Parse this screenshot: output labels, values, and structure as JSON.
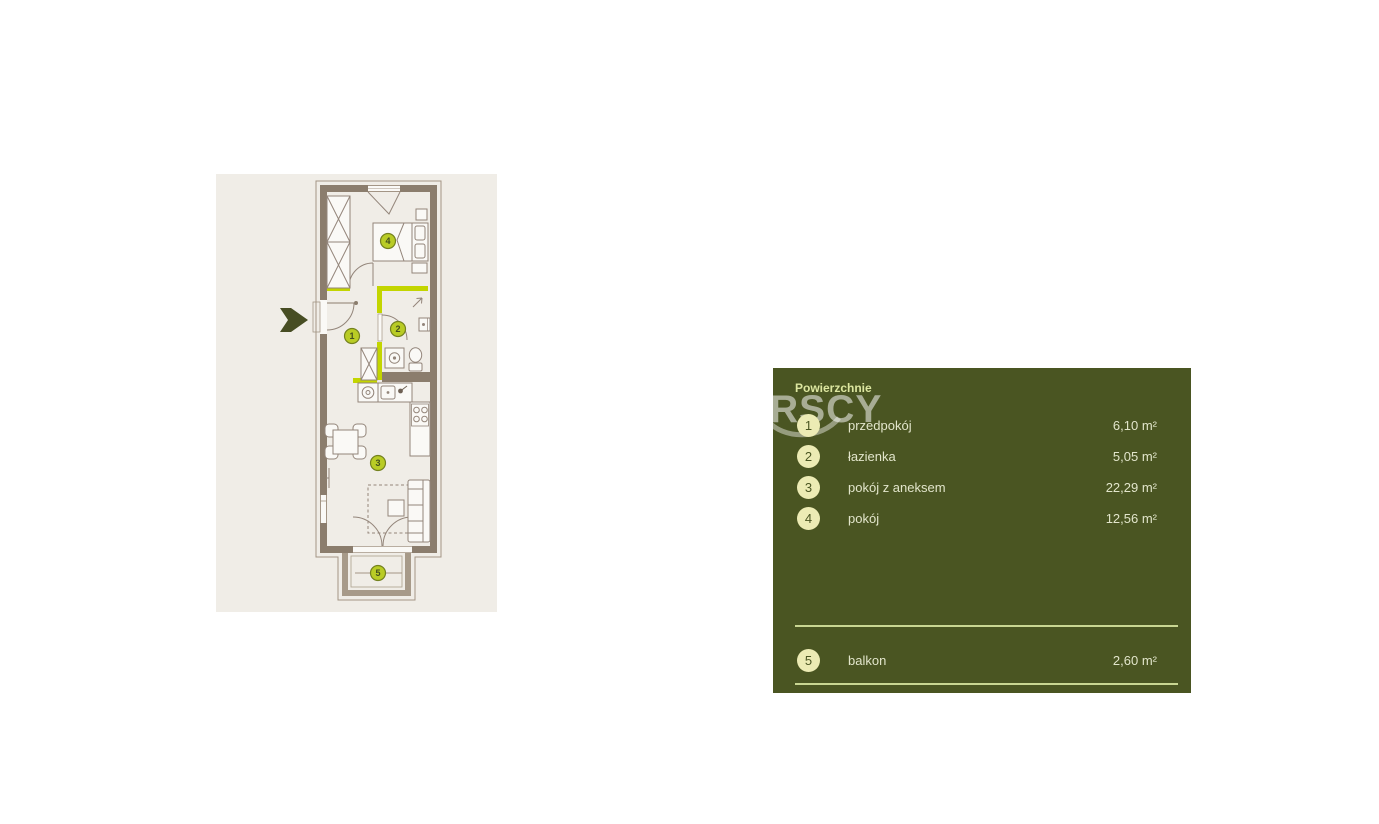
{
  "legend": {
    "title": "Powierzchnie",
    "watermark": "RSCY",
    "rows": [
      {
        "num": "1",
        "label": "przedpokój",
        "area": "6,10 m²"
      },
      {
        "num": "2",
        "label": "łazienka",
        "area": "5,05 m²"
      },
      {
        "num": "3",
        "label": "pokój z aneksem",
        "area": "22,29 m²"
      },
      {
        "num": "4",
        "label": "pokój",
        "area": "12,56 m²"
      }
    ],
    "footer_row": {
      "num": "5",
      "label": "balkon",
      "area": "2,60 m²"
    }
  },
  "plan": {
    "badges": [
      "1",
      "2",
      "3",
      "4",
      "5"
    ],
    "icons": {
      "entry_arrow": "right-chevron-arrow"
    },
    "colors": {
      "floor_background": "#f0ede7",
      "wall": "#8b7d6d",
      "balcony_wall": "#a79a89",
      "accent_wall": "#c3d500",
      "plan_badge_fill": "#b9cc25",
      "entry_arrow": "#474d23",
      "panel_background": "#4a5522",
      "panel_title": "#dce6a0",
      "panel_text": "#e2e5cb",
      "panel_badge_fill": "#ecebb4",
      "separator": "#c9d692"
    }
  }
}
